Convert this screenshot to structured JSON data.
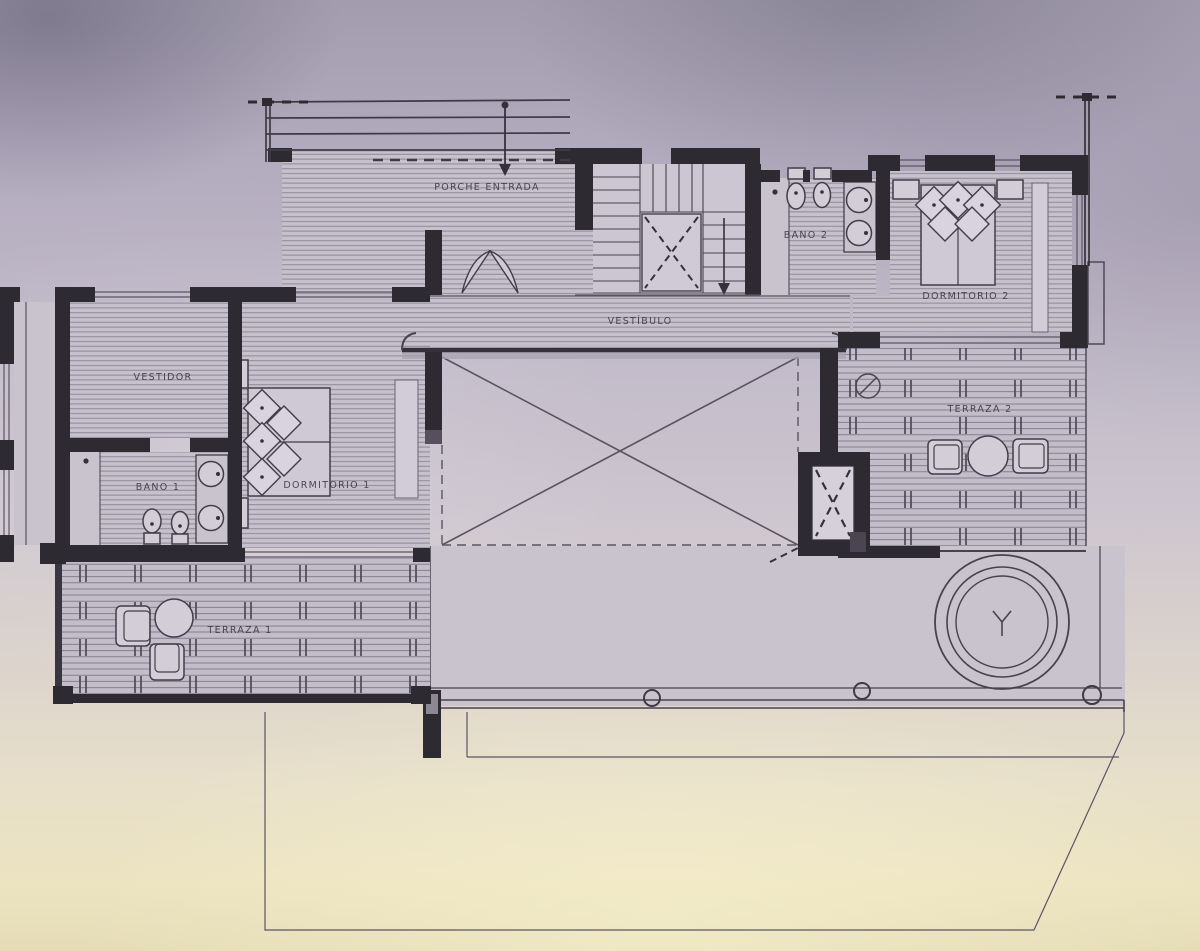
{
  "plan": {
    "type": "architectural-floor-plan",
    "floor": "upper-level",
    "rooms": {
      "porche": {
        "label": "PORCHE ENTRADA"
      },
      "vestibulo": {
        "label": "VESTÍBULO"
      },
      "bano2": {
        "label": "BAÑO 2"
      },
      "dormitorio2": {
        "label": "DORMITORIO 2"
      },
      "vestidor": {
        "label": "VESTIDOR"
      },
      "bano1": {
        "label": "BAÑO 1"
      },
      "dormitorio1": {
        "label": "DORMITORIO 1"
      },
      "terraza1": {
        "label": "TERRAZA 1"
      },
      "terraza2": {
        "label": "TERRAZA 2"
      }
    },
    "colors": {
      "wall": "#2d2a31",
      "drawing_line": "#474250",
      "hatch_line": "#8e8795",
      "room_fill": "#c7c1cd",
      "deck_fill": "#c3bdc9",
      "background_top": "#a29cae",
      "background_bottom": "#e5dcb7",
      "lower_ground": "#ece3c0"
    }
  }
}
